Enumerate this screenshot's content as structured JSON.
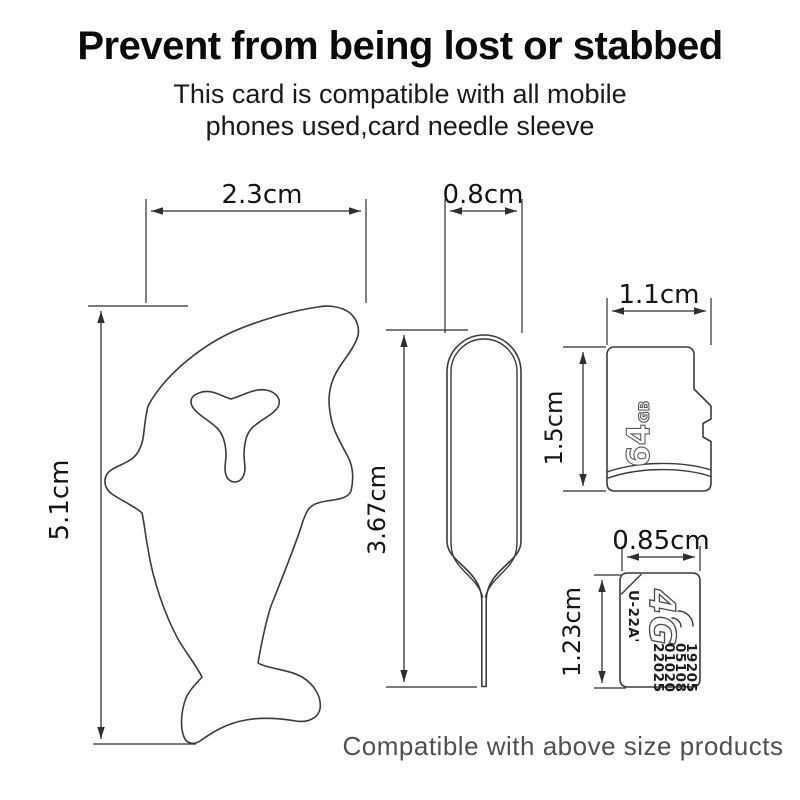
{
  "header": {
    "title": "Prevent from being lost or stabbed",
    "subtitle_line1": "This card is compatible with all mobile",
    "subtitle_line2": "phones used,card needle sleeve"
  },
  "dimensions": {
    "dolphin_width": "2.3cm",
    "dolphin_height": "5.1cm",
    "pin_width": "0.8cm",
    "pin_height": "3.67cm",
    "microsd_width": "1.1cm",
    "microsd_height": "1.5cm",
    "sim_width": "0.85cm",
    "sim_height": "1.23cm"
  },
  "microsd": {
    "capacity": "64",
    "capacity_unit": "GB"
  },
  "sim": {
    "network": "4G",
    "model": "U-22A'",
    "serial_lines": [
      "19205",
      "05108",
      "01020",
      "22025"
    ]
  },
  "footer": {
    "caption": "Compatible with above size products"
  },
  "colors": {
    "background": "#ffffff",
    "line_art": "#3b3b3b",
    "text": "#0a0a0a",
    "caption_text": "#505053"
  }
}
